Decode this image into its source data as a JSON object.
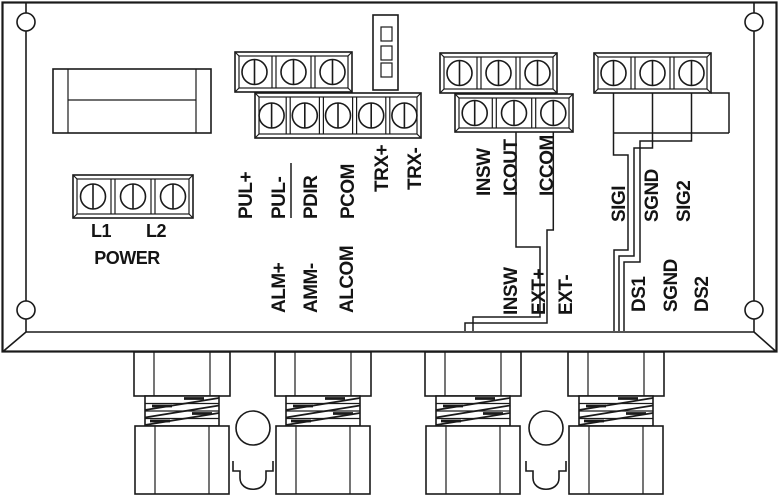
{
  "colors": {
    "line": "#1a1a1a",
    "background": "#ffffff"
  },
  "power_section": {
    "l1": "L1",
    "l2": "L2",
    "title": "POWER"
  },
  "pulse_terminals": {
    "pul_plus": "PUL+",
    "pul_minus": "PUL-",
    "pdir": "PDIR",
    "pcom": "PCOM",
    "trx_plus": "TRX+",
    "trx_minus": "TRX-"
  },
  "alarm_terminals": {
    "alm_plus": "ALM+",
    "amm_minus": "AMM-",
    "alcom": "ALCOM"
  },
  "input_terminals": {
    "insw": "INSW",
    "icout": "ICOUT",
    "iccom": "ICCOM"
  },
  "ext_terminals": {
    "insw": "INSW",
    "ext_plus": "EXT+",
    "ext_minus": "EXT-"
  },
  "signal_terminals": {
    "sigi": "SIGI",
    "sgnd": "SGND",
    "sig2": "SIG2"
  },
  "ds_terminals": {
    "ds1": "DS1",
    "sgnd": "SGND",
    "ds2": "DS2"
  }
}
